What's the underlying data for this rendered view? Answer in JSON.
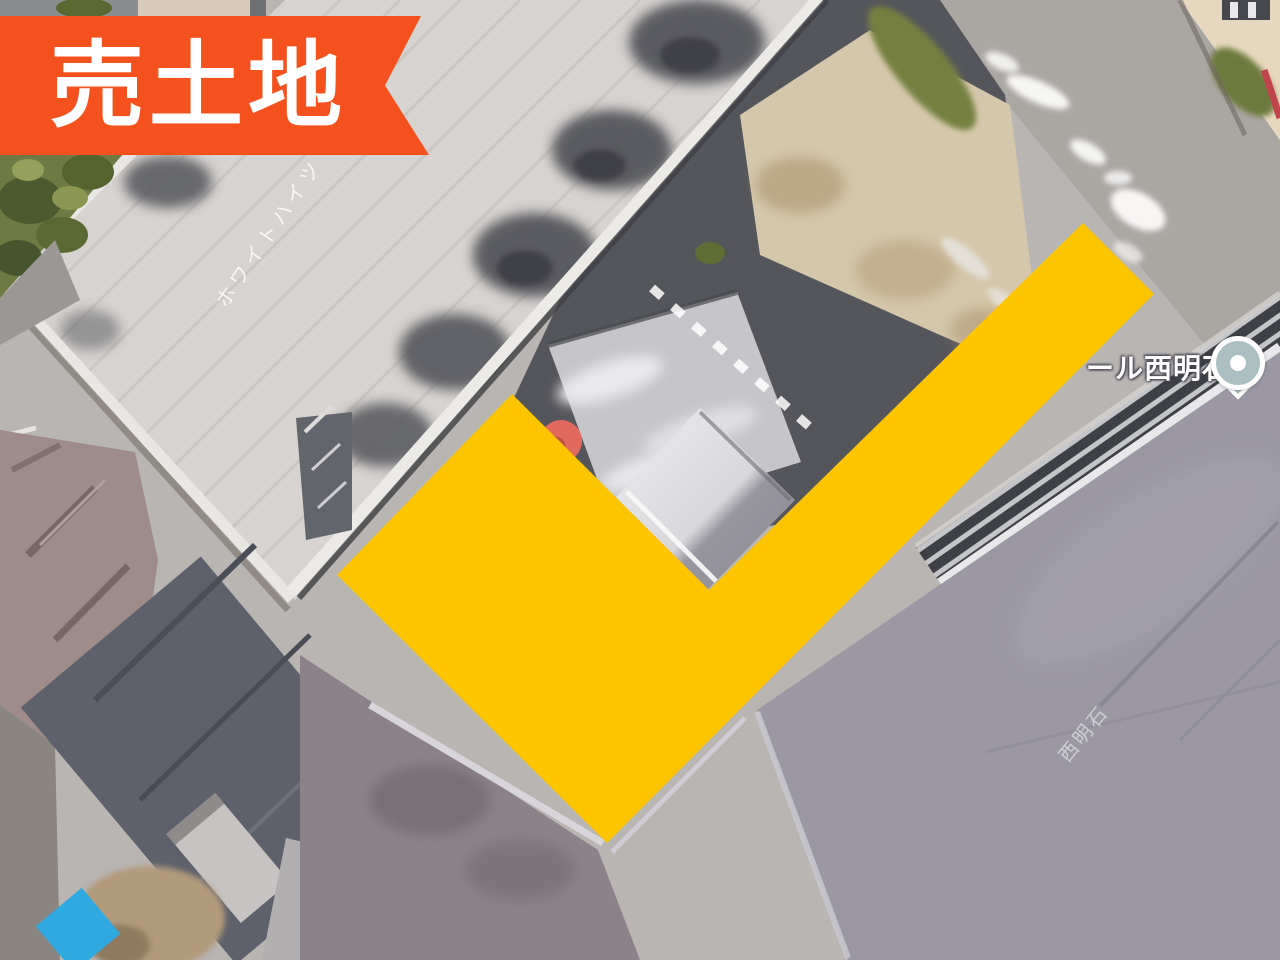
{
  "colors": {
    "ribbon_bg": "#F4511E",
    "ribbon_text": "#FFFFFF",
    "overlay_yellow": "#FCC500",
    "pin_outer": "#E2695E",
    "pin_inner": "#BF5348",
    "poi_body": "#ABBFC1",
    "poi_dot": "#FFFFFF",
    "label_text": "#FFFFFF"
  },
  "ribbon": {
    "label": "売土地"
  },
  "map": {
    "poi": {
      "label": "ール西明石"
    },
    "roof_labels": {
      "apartment": "ホワイトハイツ",
      "dark_roof": "西明石"
    }
  }
}
